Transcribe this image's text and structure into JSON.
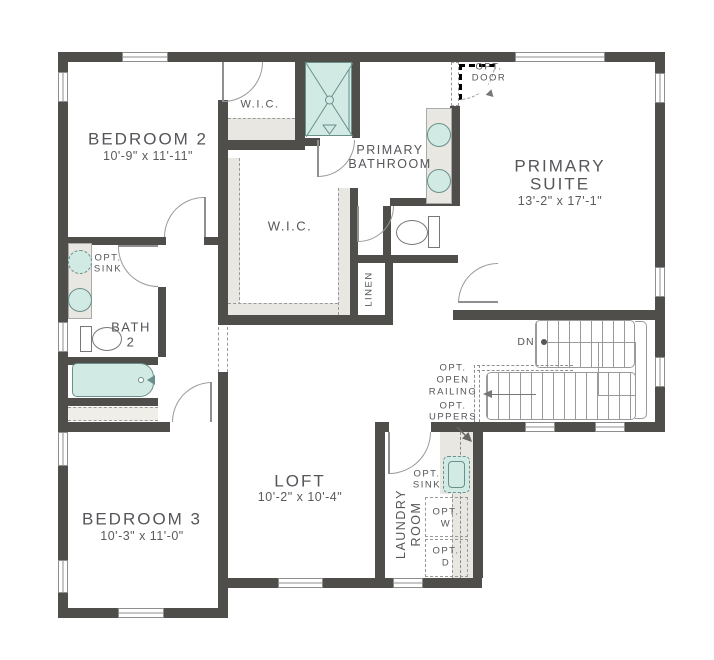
{
  "title": "Second Floor Plan",
  "colors": {
    "wall": "#4f4e4b",
    "fixture_fill": "#d2eae4",
    "fixture_line": "#6b8f8a",
    "cabinet_fill": "#e9e7e1",
    "text": "#55565a"
  },
  "rooms": {
    "bedroom2": {
      "name": "BEDROOM 2",
      "dims": "10'-9\" x 11'-11\""
    },
    "wic_small": {
      "name": "W.I.C."
    },
    "primary_bathroom": {
      "line1": "PRIMARY",
      "line2": "BATHROOM"
    },
    "primary_suite": {
      "line1": "PRIMARY",
      "line2": "SUITE",
      "dims": "13'-2\" x 17'-1\""
    },
    "wic_main": {
      "name": "W.I.C."
    },
    "linen": {
      "name": "LINEN"
    },
    "bath2": {
      "line1": "BATH",
      "line2": "2"
    },
    "bedroom3": {
      "name": "BEDROOM 3",
      "dims": "10'-3\" x 11'-0\""
    },
    "loft": {
      "name": "LOFT",
      "dims": "10'-2\" x 10'-4\""
    },
    "laundry": {
      "line1": "LAUNDRY",
      "line2": "ROOM"
    }
  },
  "annotations": {
    "opt_door": {
      "line1": "OPT.",
      "line2": "DOOR"
    },
    "opt_sink_bath": {
      "line1": "OPT.",
      "line2": "SINK"
    },
    "opt_sink_laundry": {
      "line1": "OPT.",
      "line2": "SINK"
    },
    "opt_open_railing": {
      "line1": "OPT.",
      "line2": "OPEN",
      "line3": "RAILING"
    },
    "opt_uppers": {
      "line1": "OPT.",
      "line2": "UPPERS"
    },
    "opt_washer": {
      "line1": "OPT.",
      "line2": "W"
    },
    "opt_dryer": {
      "line1": "OPT.",
      "line2": "D"
    },
    "stairs_down": {
      "label": "DN"
    }
  }
}
